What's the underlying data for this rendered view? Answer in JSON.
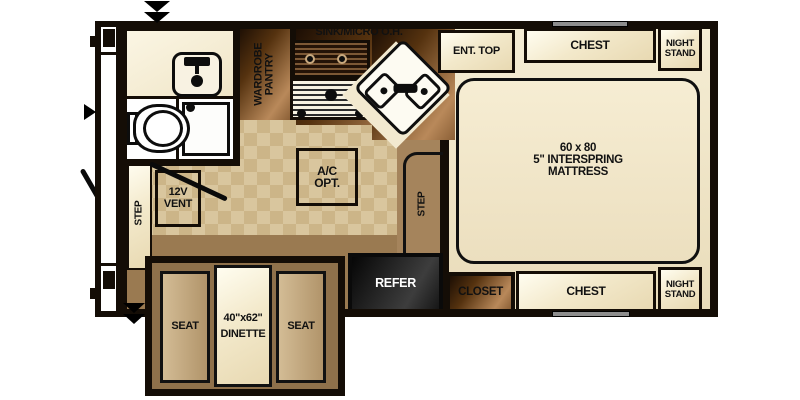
{
  "title": "Truck camper floor plan",
  "labels": {
    "sink_micro_oh": "SINK/MICRO O.H.",
    "ent_top": "ENT. TOP",
    "chest_top": "CHEST",
    "night_stand_top": "NIGHT STAND",
    "mattress": "60 x 80\n5\" INTERSPRING\nMATTRESS",
    "wardrobe_pantry": "WARDROBE\nPANTRY",
    "ac_opt": "A/C\nOPT.",
    "step_front": "STEP",
    "vent_12v": "12V\nVENT",
    "step_bed": "STEP",
    "refer": "REFER",
    "closet": "CLOSET",
    "chest_bottom": "CHEST",
    "night_stand_bottom": "NIGHT STAND",
    "seat_left": "SEAT",
    "seat_right": "SEAT",
    "dinette": "40\"x62\"\nDINETTE"
  },
  "colors": {
    "wall": "#140d06",
    "cream_furniture": "#f2e7c9",
    "tile_floor": "#d9c69e",
    "brown_floor": "#9a7a51",
    "copper_cabinet": "#8a5f36",
    "refer_box": "#1a1a1a",
    "refer_text": "#ffffff"
  }
}
